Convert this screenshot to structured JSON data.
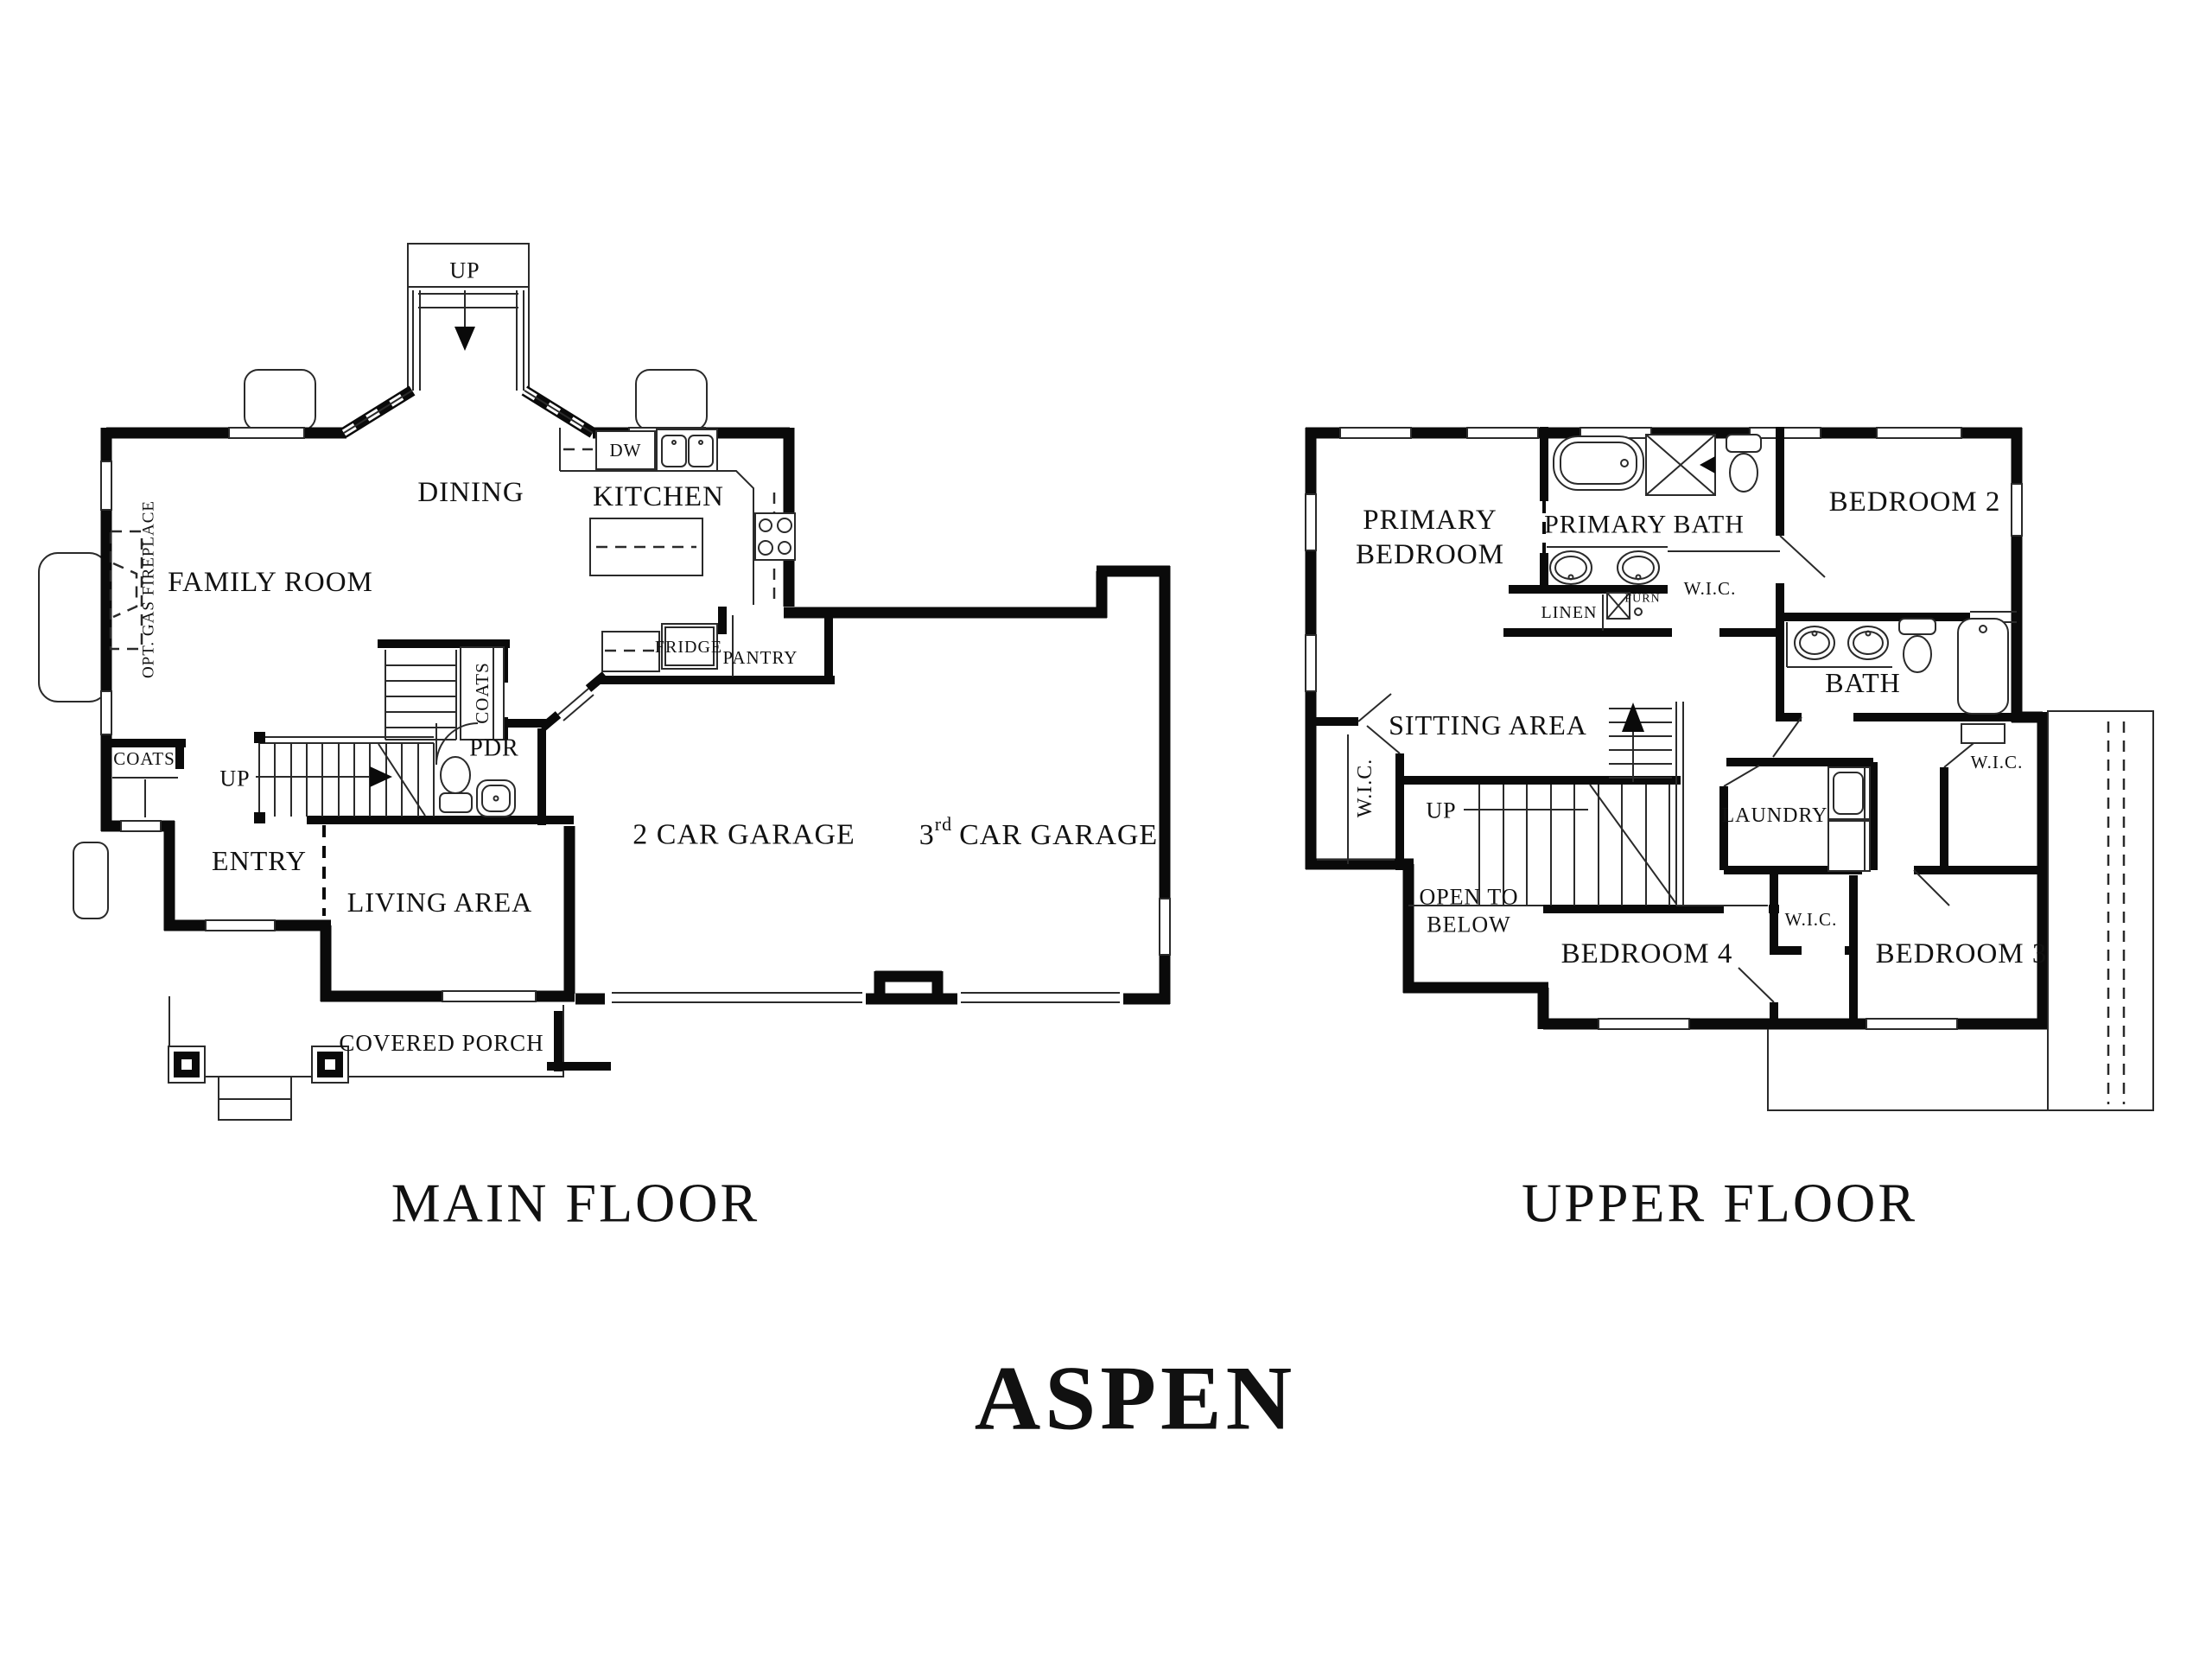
{
  "plan_name": "ASPEN",
  "colors": {
    "wall": "#0a0a0a",
    "line": "#2a2a2a",
    "text": "#111111",
    "background": "#ffffff"
  },
  "main": {
    "title": "MAIN FLOOR",
    "rooms": {
      "family": "FAMILY ROOM",
      "dining": "DINING",
      "kitchen": "KITCHEN",
      "entry": "ENTRY",
      "living": "LIVING AREA",
      "garage2": "2 CAR GARAGE",
      "pdr": "PDR",
      "porch": "COVERED PORCH"
    },
    "garage3": {
      "num": "3",
      "sup": "rd",
      "rest": "CAR GARAGE"
    },
    "small": {
      "dw": "DW",
      "fridge": "FRIDGE",
      "pantry": "PANTRY",
      "coats_closet": "COATS",
      "coats_stairs": "COATS",
      "fireplace": "OPT. GAS FIREPLACE",
      "up_bay": "UP",
      "up_stairs": "UP"
    }
  },
  "upper": {
    "title": "UPPER FLOOR",
    "rooms": {
      "primary_line1": "PRIMARY",
      "primary_line2": "BEDROOM",
      "primary_bath": "PRIMARY BATH",
      "bedroom2": "BEDROOM 2",
      "bedroom3": "BEDROOM 3",
      "bedroom4": "BEDROOM 4",
      "bath": "BATH",
      "sitting": "SITTING AREA",
      "laundry": "LAUNDRY",
      "open1": "OPEN TO",
      "open2": "BELOW"
    },
    "small": {
      "linen": "LINEN",
      "furn": "FURN",
      "wic_primary": "W.I.C.",
      "wic_left": "W.I.C.",
      "wic_right": "W.I.C.",
      "wic_mid": "W.I.C.",
      "up": "UP"
    }
  }
}
